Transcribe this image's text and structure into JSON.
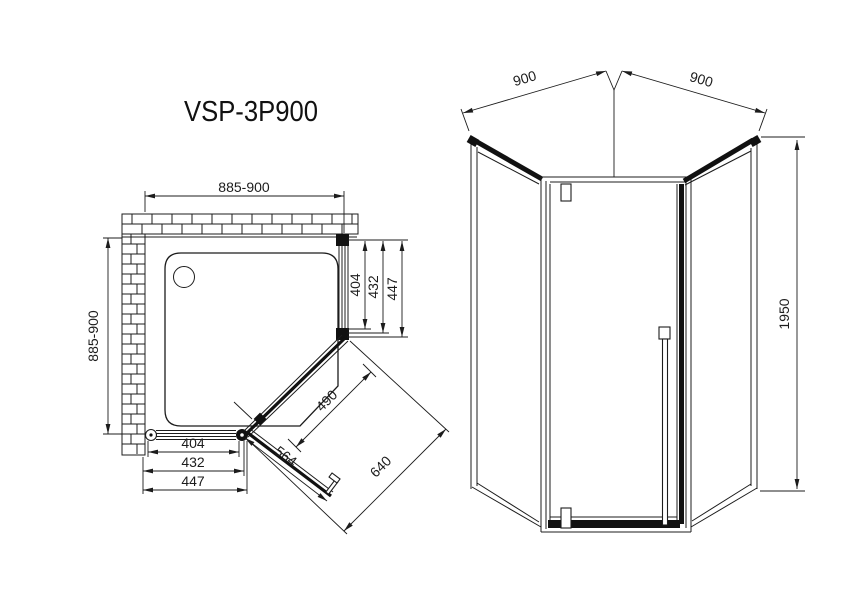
{
  "title": "VSP-3P900",
  "plan_view": {
    "top_width": "885-900",
    "left_depth": "885-900",
    "right_side_dims": [
      "404",
      "432",
      "447"
    ],
    "bottom_dims": [
      "404",
      "432",
      "447"
    ],
    "door_glass_width": "490",
    "door_panel_width": "564",
    "corner_opening_width": "640"
  },
  "elevation_view": {
    "left_panel_width": "900",
    "right_panel_width": "900",
    "height": "1950"
  }
}
